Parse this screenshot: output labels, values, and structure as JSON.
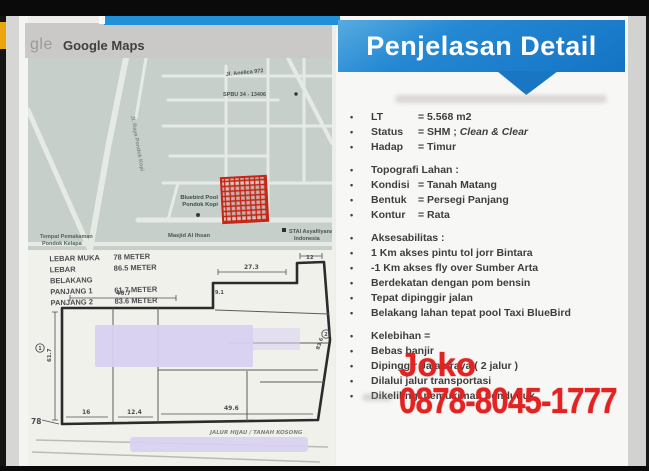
{
  "colors": {
    "banner_blue": "#1b7dcb",
    "contact_red": "#e32222",
    "plot_red": "#c62415",
    "redaction_lavender": "#d8d0f1",
    "accent_yellow": "#eaa60a"
  },
  "map_card": {
    "logo_text": "gle",
    "header_title": "Google Maps",
    "labels": {
      "street_top": "Jl. Anelica 972",
      "spbu": "SPBU 34 - 13406",
      "bluebird_line1": "Bluebird Pool",
      "bluebird_line2": "Pondok Kopi",
      "masjid": "Masjid Al Ihsan",
      "stai_line1": "STAI Asyafiiyana",
      "stai_line2": "Indonesia",
      "cemetery_line1": "Tempat Pemakaman",
      "cemetery_line2": "Pondok Kelapa",
      "road_vertical": "Jl. Raya Pondok Kopi"
    }
  },
  "sketch": {
    "notes": [
      {
        "label": "LEBAR MUKA",
        "value": "78 METER"
      },
      {
        "label": "LEBAR BELAKANG",
        "value": "86.5 METER"
      },
      {
        "label": "PANJANG 1",
        "value": "61.7 METER"
      },
      {
        "label": "PANJANG 2",
        "value": "83.6 METER"
      }
    ],
    "dimensions": {
      "front_width": "78",
      "left_side": "61.7",
      "bottom_seg1": "16",
      "bottom_seg2": "12.4",
      "bottom_seg3": "49.6",
      "back_seg1": "46.7",
      "back_seg2": "27.3",
      "back_seg3": "12",
      "step": "9.1",
      "right_side": "83.6",
      "marker1": "1",
      "marker2": "2"
    },
    "road_label": "JALUR HIJAU / TANAH KOSONG"
  },
  "right_panel": {
    "title": "Penjelasan Detail",
    "groups": [
      {
        "items": [
          {
            "label": "LT",
            "value": "= 5.568 m2"
          },
          {
            "label": "Status",
            "value": "= SHM ; ",
            "italic": "Clean & Clear"
          },
          {
            "label": "Hadap",
            "value": "= Timur"
          }
        ]
      },
      {
        "items": [
          {
            "label": "Topografi Lahan :"
          },
          {
            "label": "Kondisi",
            "value": "= Tanah Matang"
          },
          {
            "label": "Bentuk",
            "value": "= Persegi Panjang"
          },
          {
            "label": "Kontur",
            "value": "= Rata"
          }
        ]
      },
      {
        "items": [
          {
            "label": "Aksesabilitas :"
          },
          {
            "label": "1 Km akses pintu tol jorr Bintara"
          },
          {
            "label": "-1 Km akses fly over Sumber Arta"
          },
          {
            "label": "Berdekatan dengan pom bensin"
          },
          {
            "label": "Tepat dipinggir jalan"
          },
          {
            "label": "Belakang lahan tepat pool Taxi BlueBird"
          }
        ]
      },
      {
        "items": [
          {
            "label": "Kelebihan ="
          },
          {
            "label": "Bebas banjir"
          },
          {
            "label": "Dipinggir Jalan raya  ( 2 jalur )"
          },
          {
            "label": "Dilalui jalur transportasi"
          },
          {
            "label": "Dikelilingi pemukiman penduduk"
          }
        ]
      }
    ]
  },
  "overlay": {
    "name": "Joko",
    "phone": "0878-8045-1777"
  }
}
